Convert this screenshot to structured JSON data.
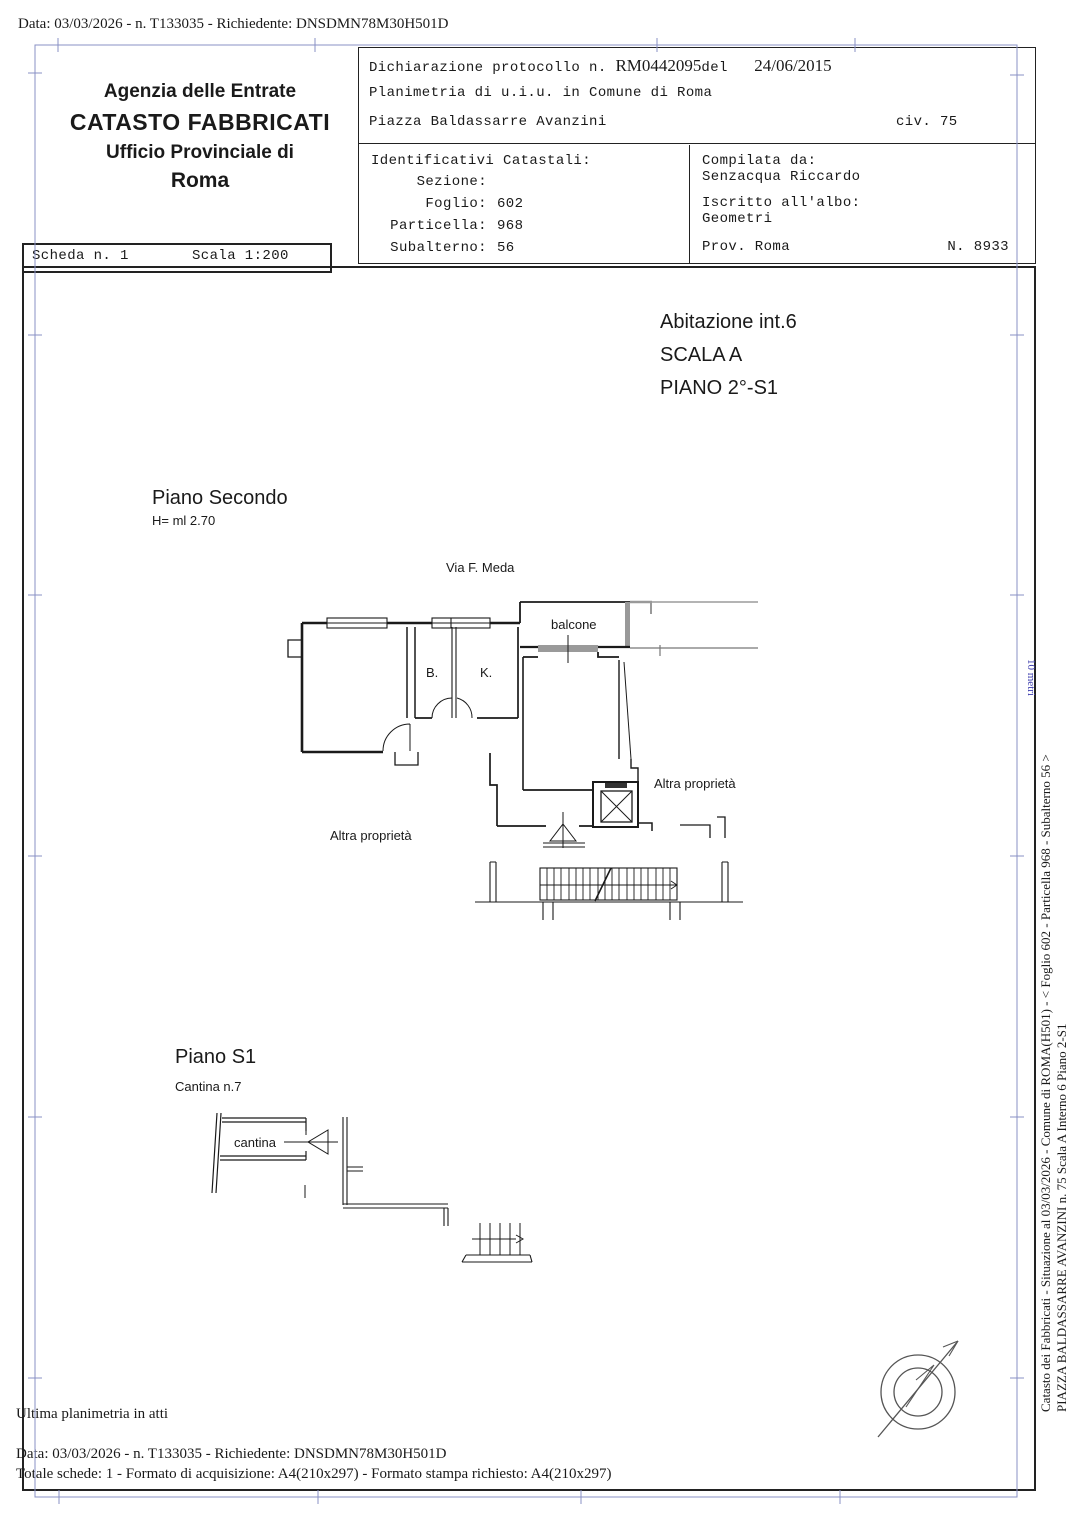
{
  "colors": {
    "blue_frame": "#8890c4",
    "blue_text": "#3d3dae",
    "ink": "#1a1a1a",
    "gray_wall": "#999999"
  },
  "top_bar": {
    "text": "Data: 03/03/2026 - n. T133035 - Richiedente: DNSDMN78M30H501D"
  },
  "header": {
    "agency": {
      "line1": "Agenzia delle Entrate",
      "line2": "CATASTO FABBRICATI",
      "line3": "Ufficio Provinciale di",
      "line4": "Roma"
    },
    "protocol": {
      "label": "Dichiarazione protocollo n.",
      "number": "RM0442095",
      "del": "del",
      "date": "24/06/2015",
      "line2": "Planimetria di u.i.u. in Comune di Roma",
      "street": "Piazza Baldassarre Avanzini",
      "civ": "civ. 75"
    },
    "identificativi": {
      "title": "Identificativi Catastali:",
      "rows": [
        {
          "label": "Sezione:",
          "value": ""
        },
        {
          "label": "Foglio:",
          "value": "602"
        },
        {
          "label": "Particella:",
          "value": "968"
        },
        {
          "label": "Subalterno:",
          "value": "56"
        }
      ]
    },
    "compilata": {
      "title": "Compilata da:",
      "name": "Senzacqua Riccardo",
      "albo_label": "Iscritto all'albo:",
      "albo": "Geometri",
      "prov": "Prov. Roma",
      "num": "N. 8933"
    },
    "scheda": {
      "label": "Scheda n. 1",
      "scala": "Scala 1:200"
    }
  },
  "drawing": {
    "unit_title": [
      "Abitazione int.6",
      "SCALA A",
      "PIANO 2°-S1"
    ],
    "piano2": {
      "title": "Piano Secondo",
      "height": "H= ml 2.70",
      "street": "Via F. Meda",
      "balcone": "balcone",
      "room_b": "B.",
      "room_k": "K.",
      "altra_left": "Altra proprietà",
      "altra_right": "Altra proprietà"
    },
    "pianoS1": {
      "title": "Piano S1",
      "subtitle": "Cantina n.7",
      "room": "cantina"
    }
  },
  "footer": {
    "ultima": "Ultima planimetria in atti",
    "data_line": "Data: 03/03/2026 - n. T133035 - Richiedente: DNSDMN78M30H501D",
    "totale_line": "Totale schede: 1 - Formato di acquisizione: A4(210x297)  - Formato stampa richiesto: A4(210x297)"
  },
  "side": {
    "line1": "Catasto dei Fabbricati - Situazione al 03/03/2026 - Comune di ROMA(H501) - <  Foglio 602 - Particella  968 - Subalterno 56 >",
    "line2": "PIAZZA BALDASSARRE AVANZINI n. 75  Scala A Interno 6 Piano 2-S1",
    "ruler_label": "10 metri"
  }
}
